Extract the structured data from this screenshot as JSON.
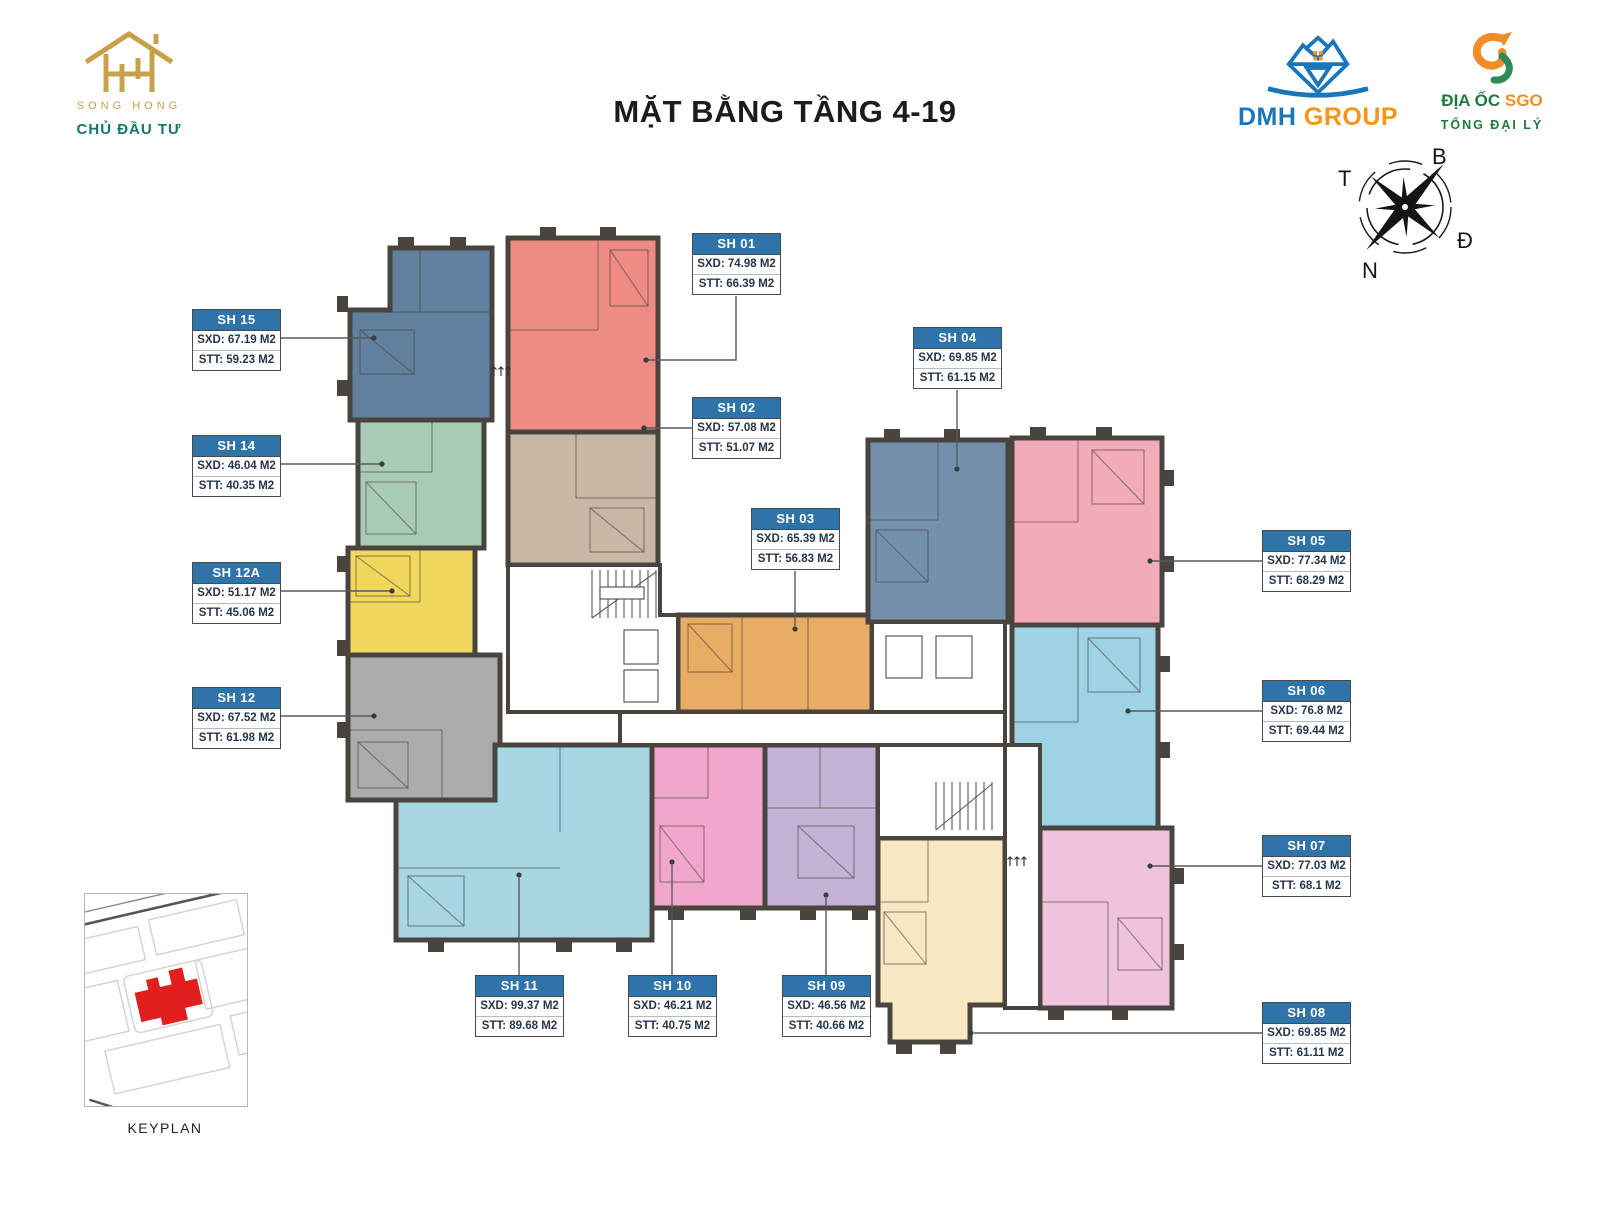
{
  "title": "MẶT BẰNG TẦNG 4-19",
  "branding": {
    "developer_name": "SONG HONG",
    "developer_role": "CHỦ ĐẦU TƯ",
    "group_brand": "DMH",
    "group_suffix": " GROUP",
    "agency_brand": "ĐỊA ỐC ",
    "agency_suffix": "SGO",
    "agency_role": "TỔNG ĐẠI LÝ"
  },
  "compass": {
    "north_label": "B",
    "east_label": "Đ",
    "south_label": "N",
    "west_label": "T"
  },
  "keyplan_label": "KEYPLAN",
  "colors": {
    "label_header": "#2E74A9",
    "wall": "#4A443E",
    "dark_text": "#26354A",
    "connector": "#55595E",
    "keyplan_building": "#E21F1F",
    "developer_gold": "#C9A04A",
    "developer_teal": "#15766B",
    "dmh_blue": "#1B75BB",
    "dmh_orange": "#F7941D",
    "sgo_green": "#1E7A3C",
    "sgo_orange": "#F28C28"
  },
  "units": [
    {
      "id": "SH 01",
      "sxd": "SXD: 74.98 M2",
      "stt": "STT: 66.39 M2",
      "color": "#ED8B84"
    },
    {
      "id": "SH 02",
      "sxd": "SXD: 57.08 M2",
      "stt": "STT: 51.07 M2",
      "color": "#C9B7A5"
    },
    {
      "id": "SH 03",
      "sxd": "SXD: 65.39 M2",
      "stt": "STT: 56.83 M2",
      "color": "#E9AC64"
    },
    {
      "id": "SH 04",
      "sxd": "SXD: 69.85 M2",
      "stt": "STT: 61.15 M2",
      "color": "#7390AD"
    },
    {
      "id": "SH 05",
      "sxd": "SXD: 77.34 M2",
      "stt": "STT: 68.29 M2",
      "color": "#F2ACB8"
    },
    {
      "id": "SH 06",
      "sxd": "SXD: 76.8 M2",
      "stt": "STT: 69.44 M2",
      "color": "#9ED3E5"
    },
    {
      "id": "SH 07",
      "sxd": "SXD: 77.03 M2",
      "stt": "STT: 68.1 M2",
      "color": "#EFC3DB"
    },
    {
      "id": "SH 08",
      "sxd": "SXD: 69.85 M2",
      "stt": "STT: 61.11 M2",
      "color": "#F8E7C3"
    },
    {
      "id": "SH 09",
      "sxd": "SXD: 46.56 M2",
      "stt": "STT: 40.66 M2",
      "color": "#C4B3D7"
    },
    {
      "id": "SH 10",
      "sxd": "SXD: 46.21 M2",
      "stt": "STT: 40.75 M2",
      "color": "#F1A7CD"
    },
    {
      "id": "SH 11",
      "sxd": "SXD: 99.37 M2",
      "stt": "STT: 89.68 M2",
      "color": "#A8D5E2"
    },
    {
      "id": "SH 12",
      "sxd": "SXD: 67.52 M2",
      "stt": "STT: 61.98 M2",
      "color": "#ACACAC"
    },
    {
      "id": "SH 12A",
      "sxd": "SXD: 51.17 M2",
      "stt": "STT: 45.06 M2",
      "color": "#F1D75E"
    },
    {
      "id": "SH 14",
      "sxd": "SXD: 46.04 M2",
      "stt": "STT: 40.35 M2",
      "color": "#A8CBB5"
    },
    {
      "id": "SH 15",
      "sxd": "SXD: 67.19 M2",
      "stt": "STT: 59.23 M2",
      "color": "#61819F"
    }
  ]
}
